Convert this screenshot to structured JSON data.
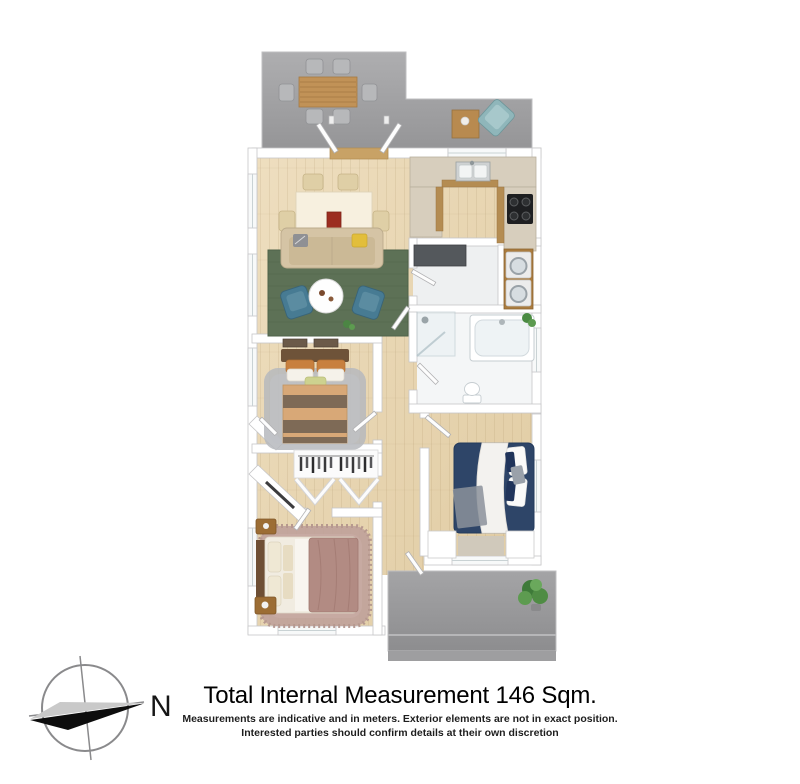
{
  "page": {
    "background_color": "#ffffff"
  },
  "floorplan": {
    "style": "3d-render-top-view",
    "rooms": [
      "upper deck",
      "dining room",
      "living room",
      "kitchen",
      "laundry",
      "bathroom",
      "bedroom",
      "walk-in wardrobe",
      "master bedroom",
      "second bedroom",
      "hallway",
      "rear patio"
    ],
    "palette": {
      "deck_gray": "#9b9b9d",
      "floor_timber": "#e7d6b4",
      "wall_white": "#ffffff",
      "wall_edge": "#c6c6c8",
      "living_rug_green": "#5d7156",
      "armchair_teal": "#477b93",
      "sofa_beige": "#d5c4a5",
      "bed_navy": "#2e4568",
      "bed_mauve": "#b28b83",
      "bed_stripe_brown": "#7e6a56",
      "bed_stripe_tan": "#d8a877",
      "timber_furniture": "#b48c52",
      "appliance_dark": "#54585c",
      "plant_green": "#4c8544"
    }
  },
  "compass": {
    "label": "N"
  },
  "footer": {
    "title": "Total Internal Measurement 146 Sqm.",
    "disclaimer_line1": "Measurements are indicative and in meters. Exterior elements are not in exact position.",
    "disclaimer_line2": "Interested parties should confirm details at their own discretion"
  }
}
